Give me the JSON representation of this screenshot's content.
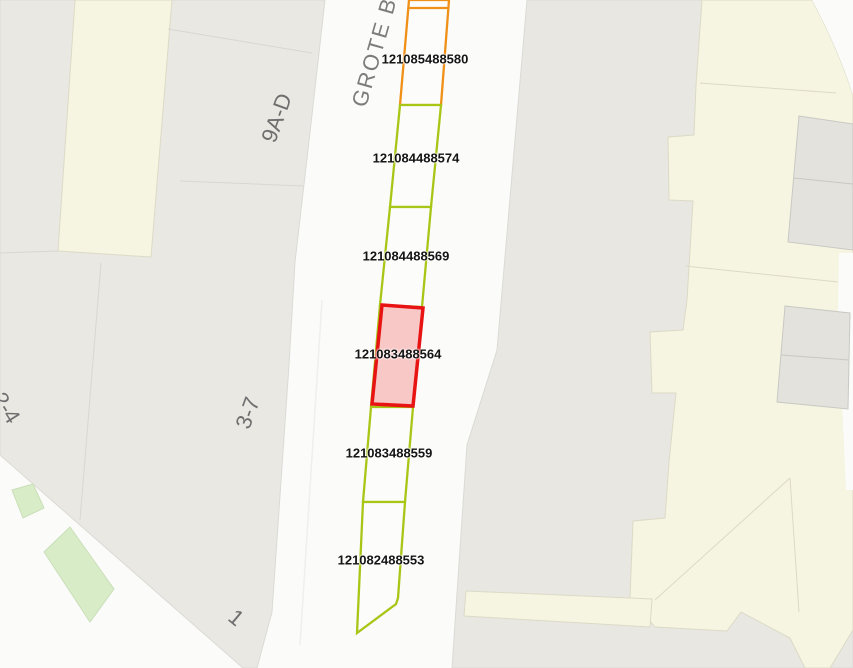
{
  "map": {
    "street_label": "GROTE BE",
    "house_numbers": {
      "right_top": "9A-D",
      "right_mid": "3-7",
      "bottom": "1",
      "left_edge": "2-4"
    },
    "parcels": [
      {
        "id": "121085488580",
        "status": "reserved"
      },
      {
        "id": "121084488574",
        "status": "available"
      },
      {
        "id": "121084488569",
        "status": "available"
      },
      {
        "id": "121083488564",
        "status": "selected"
      },
      {
        "id": "121083488559",
        "status": "available"
      },
      {
        "id": "121082488553",
        "status": "available"
      }
    ],
    "colors": {
      "available": "#a8c616",
      "reserved": "#f09016",
      "selected": "#e81414",
      "selected_fill": "#f8c8c6",
      "building_gray": "#e9e8e3",
      "building_cream": "#f6f5e1",
      "grass_green": "#d8ecc8",
      "road_white": "#fbfbfa"
    }
  }
}
